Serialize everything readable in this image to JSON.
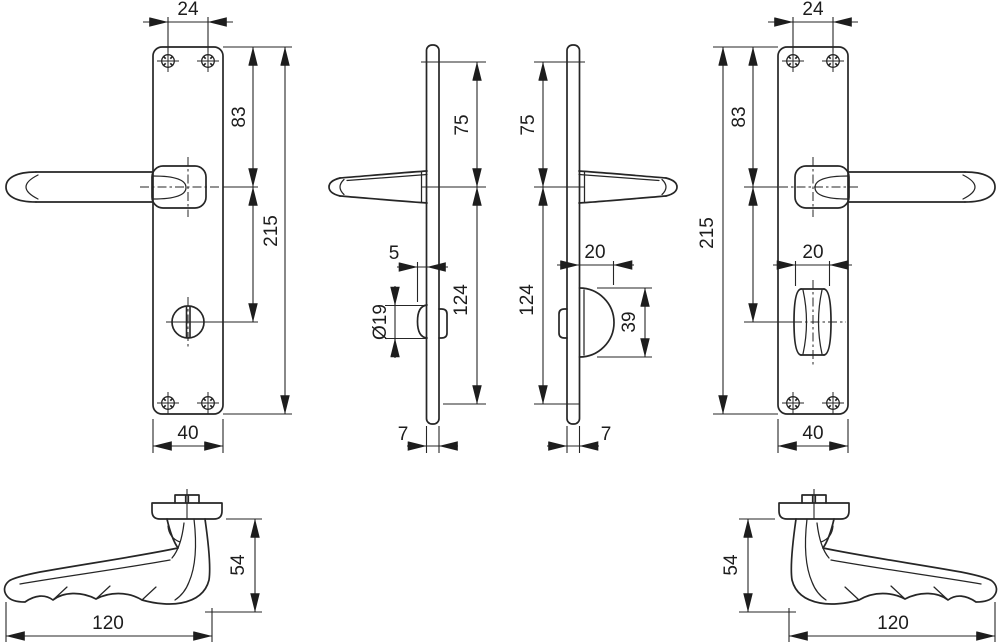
{
  "drawing": {
    "colors": {
      "line": "#262626",
      "background": "#ffffff"
    },
    "views": {
      "front_left": {
        "label": "front-view-lever-with-wc-release",
        "dims": {
          "screw_spacing": "24",
          "top_to_handle": "83",
          "height": "215",
          "width": "40"
        }
      },
      "side_left": {
        "label": "side-profile-left",
        "dims": {
          "screw_to_handle": "75",
          "turn_protrusion": "5",
          "turn_diameter": "Ø19",
          "handle_to_bottom_screw": "124",
          "thickness": "7"
        }
      },
      "side_right": {
        "label": "side-profile-right",
        "dims": {
          "screw_to_handle": "75",
          "turn_protrusion": "20",
          "turn_height": "39",
          "handle_to_bottom_screw": "124",
          "thickness": "7"
        }
      },
      "front_right": {
        "label": "front-view-lever-with-wc-turn",
        "dims": {
          "screw_spacing": "24",
          "top_to_handle": "83",
          "height": "215",
          "turn_width": "20",
          "width": "40"
        }
      },
      "lever_left": {
        "label": "lever-handle-top-view-left",
        "dims": {
          "height": "54",
          "length": "120"
        }
      },
      "lever_right": {
        "label": "lever-handle-top-view-right",
        "dims": {
          "height": "54",
          "length": "120"
        }
      }
    }
  }
}
